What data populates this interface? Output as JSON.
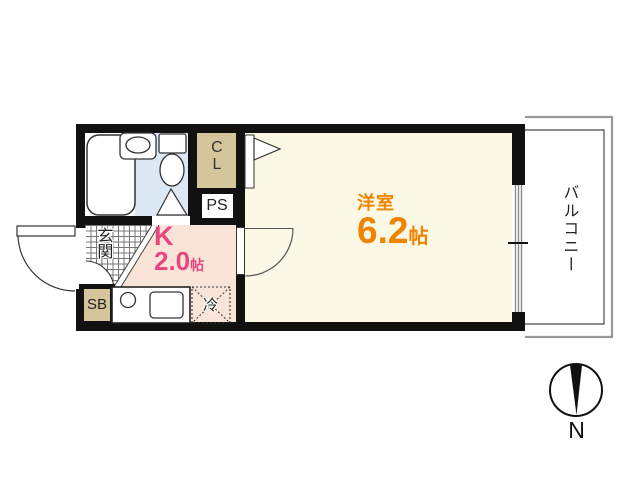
{
  "rooms": {
    "western_room": {
      "name": "洋室",
      "size": "6.2",
      "unit": "帖"
    },
    "kitchen": {
      "name": "K",
      "size": "2.0",
      "unit": "帖"
    },
    "entrance": {
      "name": "玄関"
    },
    "balcony": {
      "name": "バルコニー"
    },
    "closet": {
      "name": "CL"
    },
    "pipe_space": {
      "name": "PS"
    },
    "shoe_box": {
      "name": "SB"
    },
    "refrigerator": {
      "name": "冷"
    }
  },
  "compass": {
    "north": "N"
  },
  "colors": {
    "wall": "#111111",
    "room_floor": "#fcf8e6",
    "kitchen_floor": "#fae4d8",
    "bath_floor": "#dce9f5",
    "tan": "#d5c59b",
    "white": "#ffffff",
    "accent_pink": "#e8467f",
    "accent_orange": "#ee8400",
    "balcony_line": "#999999"
  }
}
